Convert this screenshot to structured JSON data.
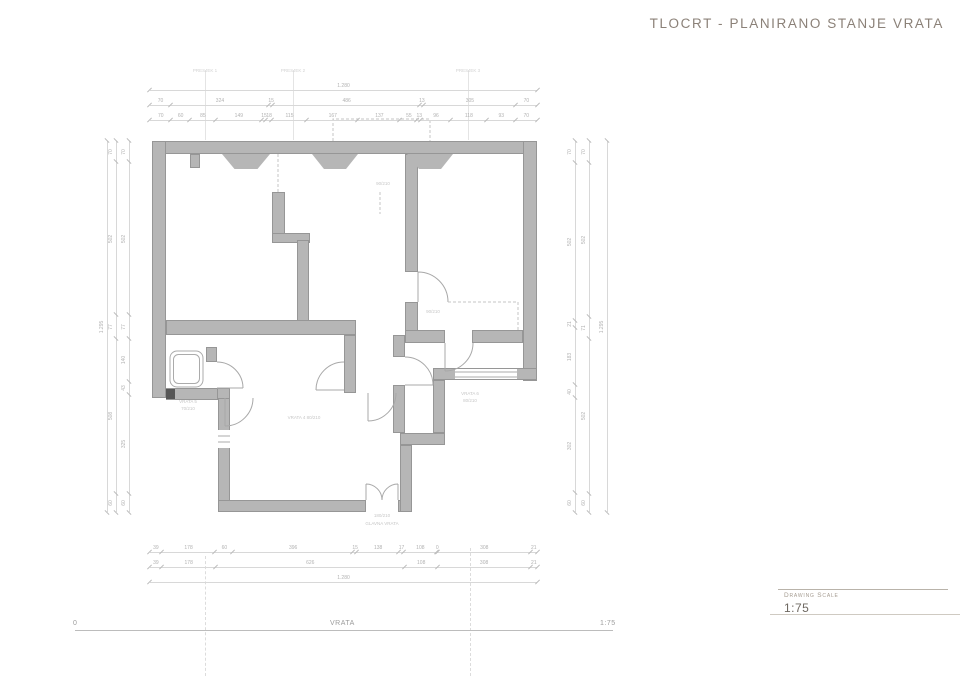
{
  "title": "TLOCRT - PLANIRANO STANJE VRATA",
  "title_block": {
    "label": "Drawing Scale",
    "scale": "1:75"
  },
  "scale_bar": {
    "left": "0",
    "center": "VRATA",
    "right": "1:75"
  },
  "section_labels": [
    {
      "text": "PRESJEK 1",
      "x": 205
    },
    {
      "text": "PRESJEK 2",
      "x": 293
    },
    {
      "text": "PRESJEK 3",
      "x": 468
    }
  ],
  "dimensions": {
    "top": {
      "overall": "1.280",
      "row2": [
        "70",
        "324",
        "15",
        "486",
        "13",
        "305",
        "70"
      ],
      "row3": [
        "70",
        "60",
        "85",
        "149",
        "15",
        "18",
        "115",
        "167",
        "137",
        "55",
        "13",
        "96",
        "118",
        "93",
        "70"
      ]
    },
    "bottom": {
      "row1": [
        "39",
        "178",
        "60",
        "396",
        "15",
        "138",
        "17",
        "108",
        "0",
        "308",
        "21"
      ],
      "row2": [
        "39",
        "178",
        "626",
        "108",
        "308",
        "21"
      ],
      "overall": "1.280"
    },
    "left": {
      "overall": "1.295",
      "outer": [
        "70",
        "502",
        "77",
        "508",
        "60"
      ],
      "inner": [
        "70",
        "502",
        "77",
        "140",
        "43",
        "325",
        "60"
      ]
    },
    "right": {
      "overall": "1.295",
      "inner": [
        "70",
        "502",
        "21",
        "183",
        "40",
        "302",
        "60"
      ],
      "outer": [
        "70",
        "502",
        "71",
        "502",
        "60"
      ]
    }
  },
  "plan_labels": [
    {
      "text": "90/210",
      "x": 383,
      "y": 181
    },
    {
      "text": "90/210",
      "x": 433,
      "y": 309
    },
    {
      "text": "VRATA 5",
      "x": 188,
      "y": 399
    },
    {
      "text": "70/210",
      "x": 188,
      "y": 406
    },
    {
      "text": "VRATA 4  80/210",
      "x": 304,
      "y": 415
    },
    {
      "text": "VRATA 6",
      "x": 470,
      "y": 391
    },
    {
      "text": "80/210",
      "x": 470,
      "y": 398
    },
    {
      "text": "180/210",
      "x": 382,
      "y": 513
    },
    {
      "text": "GLAVNA VRATA",
      "x": 382,
      "y": 521
    }
  ]
}
